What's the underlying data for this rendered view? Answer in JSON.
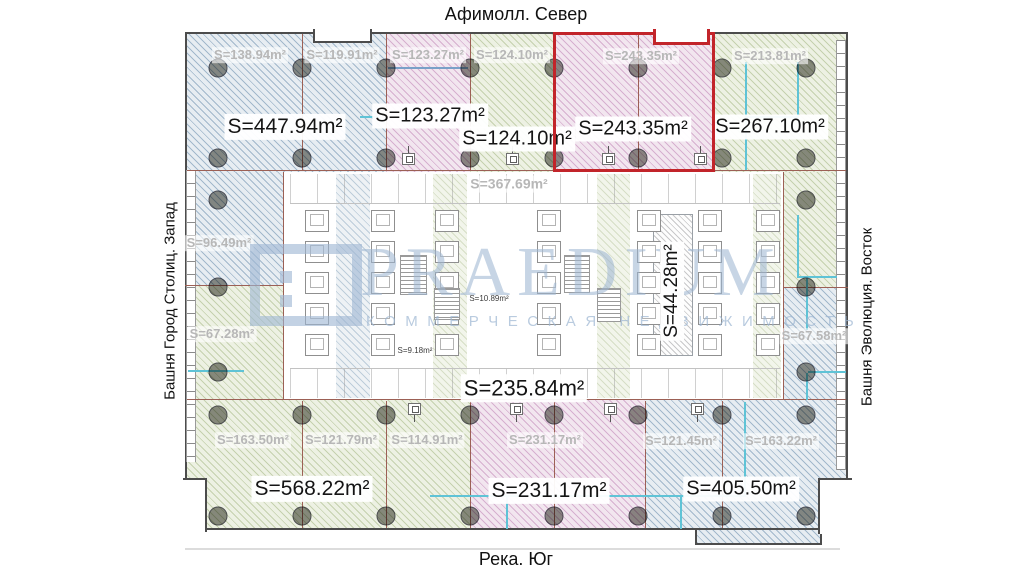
{
  "compass": {
    "north": "Афимолл. Север",
    "south": "Река. Юг",
    "west": "Башня Город Столиц. Запад",
    "east": "Башня Эволюция. Восток"
  },
  "watermark": {
    "brand": "PRAEDIUM",
    "tagline": "КОММЕРЧЕСКАЯ НЕДВИЖИМОСТЬ"
  },
  "colors": {
    "highlight_border": "#c2242a",
    "structure_line": "#9c6055",
    "partition_cyan": "#5fc3d6",
    "watermark_blue": "#9eb7d3",
    "hatch_blue": "#e7edf2",
    "hatch_pink": "#f2e6ef",
    "hatch_green": "#edf1e3"
  },
  "areas": {
    "large": [
      {
        "text": "S=447.94m²",
        "x": 285,
        "y": 127,
        "fs": 21
      },
      {
        "text": "S=123.27m²",
        "x": 430,
        "y": 116,
        "fs": 20
      },
      {
        "text": "S=124.10m²",
        "x": 517,
        "y": 139,
        "fs": 20
      },
      {
        "text": "S=243.35m²",
        "x": 633,
        "y": 129,
        "fs": 20
      },
      {
        "text": "S=267.10m²",
        "x": 770,
        "y": 127,
        "fs": 20
      },
      {
        "text": "S=235.84m²",
        "x": 524,
        "y": 388,
        "fs": 22
      },
      {
        "text": "S=44.28m²",
        "x": 672,
        "y": 291,
        "fs": 19,
        "rot": true
      },
      {
        "text": "S=568.22m²",
        "x": 312,
        "y": 489,
        "fs": 21
      },
      {
        "text": "S=231.17m²",
        "x": 549,
        "y": 491,
        "fs": 21
      },
      {
        "text": "S=405.50m²",
        "x": 741,
        "y": 489,
        "fs": 20
      }
    ],
    "faded": [
      {
        "text": "S=138.94m²",
        "x": 250,
        "y": 55,
        "fs": 13
      },
      {
        "text": "S=119.91m²",
        "x": 342,
        "y": 55,
        "fs": 13
      },
      {
        "text": "S=123.27m²",
        "x": 428,
        "y": 55,
        "fs": 13
      },
      {
        "text": "S=124.10m²",
        "x": 512,
        "y": 55,
        "fs": 13
      },
      {
        "text": "S=243.35m²",
        "x": 641,
        "y": 56,
        "fs": 13
      },
      {
        "text": "S=213.81m²",
        "x": 770,
        "y": 56,
        "fs": 13
      },
      {
        "text": "S=96.49m²",
        "x": 219,
        "y": 243,
        "fs": 13
      },
      {
        "text": "S=67.28m²",
        "x": 222,
        "y": 334,
        "fs": 13
      },
      {
        "text": "S=367.69m²",
        "x": 509,
        "y": 184,
        "fs": 14
      },
      {
        "text": "S=67.58m²",
        "x": 814,
        "y": 336,
        "fs": 13
      },
      {
        "text": "S=163.50m²",
        "x": 253,
        "y": 440,
        "fs": 13
      },
      {
        "text": "S=121.79m²",
        "x": 341,
        "y": 440,
        "fs": 13
      },
      {
        "text": "S=114.91m²",
        "x": 427,
        "y": 440,
        "fs": 13
      },
      {
        "text": "S=231.17m²",
        "x": 545,
        "y": 440,
        "fs": 13
      },
      {
        "text": "S=121.45m²",
        "x": 681,
        "y": 441,
        "fs": 13
      },
      {
        "text": "S=163.22m²",
        "x": 781,
        "y": 441,
        "fs": 13
      }
    ],
    "small": [
      {
        "text": "S=10.89m²",
        "x": 489,
        "y": 299,
        "fs": 8
      },
      {
        "text": "S=9.18m²",
        "x": 415,
        "y": 351,
        "fs": 8
      }
    ]
  }
}
